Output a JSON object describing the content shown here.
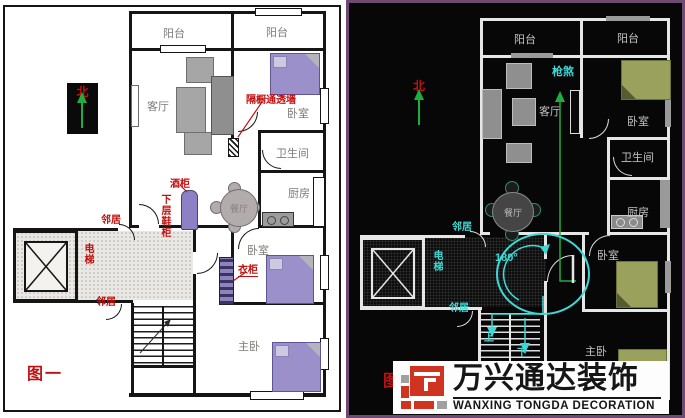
{
  "left_panel": {
    "figure_label": "图一",
    "compass_north": "北",
    "rooms": {
      "balcony1": "阳台",
      "balcony2": "阳台",
      "living": "客厅",
      "bedroom1": "卧室",
      "bathroom": "卫生间",
      "kitchen": "厨房",
      "dining": "餐厅",
      "bedroom2": "卧室",
      "master": "主卧"
    },
    "annotations": {
      "partition": "隔橱通透墙",
      "wine_cabinet": "酒柜",
      "shoe_cabinet": "下层鞋柜",
      "neighbor_top": "邻居",
      "neighbor_bottom": "邻居",
      "elevator": "电梯",
      "wardrobe": "衣柜"
    },
    "colors": {
      "annotation": "#c21010",
      "bed": "#9b90ca",
      "wall": "#151515"
    }
  },
  "right_panel": {
    "figure_label": "图二",
    "compass_north": "北",
    "rooms": {
      "balcony1": "阳台",
      "balcony2": "阳台",
      "living": "客厅",
      "bedroom1": "卧室",
      "bathroom": "卫生间",
      "kitchen": "厨房",
      "dining": "餐厅",
      "bedroom2": "卧室",
      "master": "主卧"
    },
    "annotations": {
      "gun_sha": "枪煞",
      "angle": "180°",
      "neighbor_top": "邻居",
      "neighbor_bottom": "邻居",
      "elevator": "电梯",
      "stairs_up": "上",
      "stairs_down": "下"
    },
    "colors": {
      "annotation": "#3cd9d6",
      "arrow": "#1fae3d",
      "bed": "#9aa15c",
      "wall": "#e6e6e6",
      "border": "#6f4a72"
    }
  },
  "watermark": {
    "cn": "万兴通达装饰",
    "en": "WANXING TONGDA DECORATION",
    "colors": {
      "red": "#d03420",
      "gray": "#a0a0a0"
    }
  }
}
